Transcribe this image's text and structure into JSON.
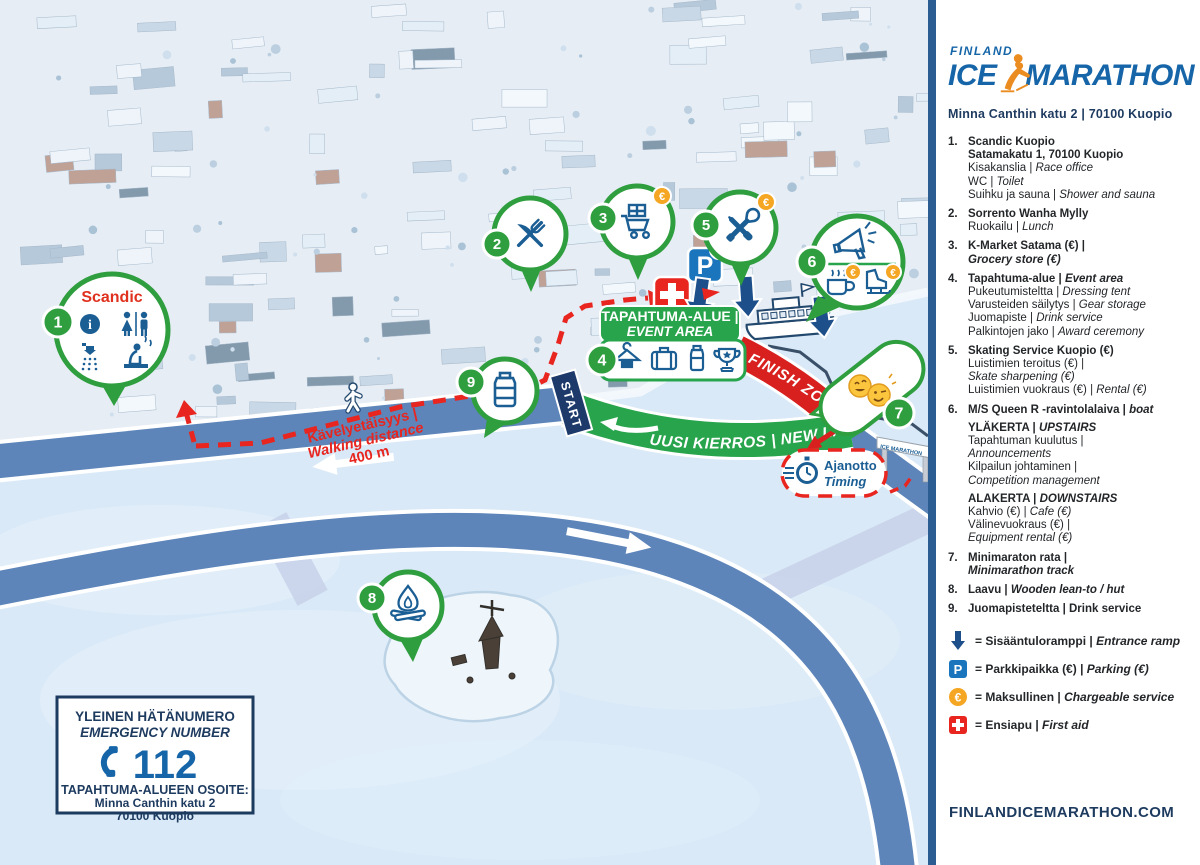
{
  "logo": {
    "finland": "FINLAND",
    "ice": "ICE",
    "marathon": "MARATHON",
    "address": "Minna Canthin katu 2  |  70100 Kuopio"
  },
  "legend": {
    "items": [
      {
        "num": "1.",
        "lines": [
          {
            "segs": [
              {
                "t": "Scandic Kuopio",
                "s": "b"
              }
            ]
          },
          {
            "segs": [
              {
                "t": "Satamakatu 1, 70100 Kuopio",
                "s": "b"
              }
            ]
          },
          {
            "segs": [
              {
                "t": "Kisakanslia | ",
                "s": "r"
              },
              {
                "t": "Race office",
                "s": "i"
              }
            ]
          },
          {
            "segs": [
              {
                "t": "WC | ",
                "s": "r"
              },
              {
                "t": "Toilet",
                "s": "i"
              }
            ]
          },
          {
            "segs": [
              {
                "t": "Suihku ja sauna | ",
                "s": "r"
              },
              {
                "t": "Shower and sauna",
                "s": "i"
              }
            ]
          }
        ]
      },
      {
        "num": "2.",
        "lines": [
          {
            "segs": [
              {
                "t": "Sorrento Wanha Mylly",
                "s": "b"
              }
            ]
          },
          {
            "segs": [
              {
                "t": "Ruokailu | ",
                "s": "r"
              },
              {
                "t": "Lunch",
                "s": "i"
              }
            ]
          }
        ]
      },
      {
        "num": "3.",
        "lines": [
          {
            "segs": [
              {
                "t": "K-Market Satama (€) |",
                "s": "b"
              }
            ]
          },
          {
            "segs": [
              {
                "t": "Grocery store (€)",
                "s": "bi"
              }
            ]
          }
        ]
      },
      {
        "num": "4.",
        "lines": [
          {
            "segs": [
              {
                "t": "Tapahtuma-alue | ",
                "s": "b"
              },
              {
                "t": "Event area",
                "s": "bi"
              }
            ]
          },
          {
            "segs": [
              {
                "t": "Pukeutumisteltta | ",
                "s": "r"
              },
              {
                "t": "Dressing tent",
                "s": "i"
              }
            ]
          },
          {
            "segs": [
              {
                "t": "Varusteiden säilytys | ",
                "s": "r"
              },
              {
                "t": "Gear storage",
                "s": "i"
              }
            ]
          },
          {
            "segs": [
              {
                "t": "Juomapiste | ",
                "s": "r"
              },
              {
                "t": "Drink service",
                "s": "i"
              }
            ]
          },
          {
            "segs": [
              {
                "t": "Palkintojen jako | ",
                "s": "r"
              },
              {
                "t": "Award ceremony",
                "s": "i"
              }
            ]
          }
        ]
      },
      {
        "num": "5.",
        "lines": [
          {
            "segs": [
              {
                "t": "Skating Service Kuopio (€)",
                "s": "b"
              }
            ]
          },
          {
            "segs": [
              {
                "t": "Luistimien teroitus (€) |",
                "s": "r"
              }
            ]
          },
          {
            "segs": [
              {
                "t": "Skate sharpening (€)",
                "s": "i"
              }
            ]
          },
          {
            "segs": [
              {
                "t": "Luistimien vuokraus (€) | ",
                "s": "r"
              },
              {
                "t": "Rental (€)",
                "s": "i"
              }
            ]
          }
        ]
      },
      {
        "num": "6.",
        "lines": [
          {
            "segs": [
              {
                "t": "M/S Queen R -ravintolalaiva | ",
                "s": "b"
              },
              {
                "t": "boat",
                "s": "bi"
              }
            ]
          },
          {
            "mt": true,
            "segs": [
              {
                "t": "YLÄKERTA | ",
                "s": "b"
              },
              {
                "t": "UPSTAIRS",
                "s": "bi"
              }
            ]
          },
          {
            "segs": [
              {
                "t": "Tapahtuman kuulutus |",
                "s": "r"
              }
            ]
          },
          {
            "segs": [
              {
                "t": "Announcements",
                "s": "i"
              }
            ]
          },
          {
            "segs": [
              {
                "t": "Kilpailun johtaminen |",
                "s": "r"
              }
            ]
          },
          {
            "segs": [
              {
                "t": "Competition management",
                "s": "i"
              }
            ]
          },
          {
            "mt": true,
            "segs": [
              {
                "t": "ALAKERTA | ",
                "s": "b"
              },
              {
                "t": "DOWNSTAIRS",
                "s": "bi"
              }
            ]
          },
          {
            "segs": [
              {
                "t": "Kahvio (€) | ",
                "s": "r"
              },
              {
                "t": "Cafe (€)",
                "s": "i"
              }
            ]
          },
          {
            "segs": [
              {
                "t": "Välinevuokraus (€) |",
                "s": "r"
              }
            ]
          },
          {
            "segs": [
              {
                "t": "Equipment rental (€)",
                "s": "i"
              }
            ]
          }
        ]
      },
      {
        "num": "7.",
        "lines": [
          {
            "segs": [
              {
                "t": "Minimaraton rata |",
                "s": "b"
              }
            ]
          },
          {
            "segs": [
              {
                "t": "Minimarathon track",
                "s": "bi"
              }
            ]
          }
        ]
      },
      {
        "num": "8.",
        "lines": [
          {
            "segs": [
              {
                "t": "Laavu | ",
                "s": "b"
              },
              {
                "t": "Wooden lean-to / hut",
                "s": "bi"
              }
            ]
          }
        ]
      },
      {
        "num": "9.",
        "lines": [
          {
            "segs": [
              {
                "t": "Juomapisteteltta | Drink service",
                "s": "b"
              }
            ]
          }
        ]
      }
    ]
  },
  "symbols": [
    {
      "icon": "entrance-ramp",
      "segs": [
        {
          "t": "= Sisääntuloramppi | ",
          "s": "b"
        },
        {
          "t": "Entrance ramp",
          "s": "bi"
        }
      ]
    },
    {
      "icon": "parking",
      "segs": [
        {
          "t": "= Parkkipaikka (€) | ",
          "s": "b"
        },
        {
          "t": "Parking (€)",
          "s": "bi"
        }
      ]
    },
    {
      "icon": "chargeable",
      "segs": [
        {
          "t": "= Maksullinen | ",
          "s": "b"
        },
        {
          "t": "Chargeable service",
          "s": "bi"
        }
      ]
    },
    {
      "icon": "first-aid",
      "segs": [
        {
          "t": "= Ensiapu | ",
          "s": "b"
        },
        {
          "t": "First aid",
          "s": "bi"
        }
      ]
    }
  ],
  "website": "FINLANDICEMARATHON.COM",
  "map": {
    "markers": [
      "1",
      "2",
      "3",
      "4",
      "5",
      "6",
      "7",
      "8",
      "9"
    ],
    "euro": "€",
    "parking": "P",
    "scandic_label": "Scandic",
    "event_area_line1": "TAPAHTUMA-ALUE |",
    "event_area_line2": "EVENT AREA",
    "start_label": "START",
    "new_lap_label": "UUSI KIERROS | NEW LAP",
    "finish_zone_label": "FINISH ZONE",
    "walking_line1": "Kävelyetäisyys |",
    "walking_line2": "Walking distance",
    "walking_line3": "400 m",
    "timing_fi": "Ajanotto",
    "timing_en": "Timing",
    "gate_label": "ICE MARATHON",
    "emergency": {
      "title_fi": "YLEINEN HÄTÄNUMERO",
      "title_en": "EMERGENCY NUMBER",
      "number": "112",
      "address_label": "TAPAHTUMA-ALUEEN OSOITE:",
      "address_line1": "Minna Canthin katu 2",
      "address_line2": "70100 Kuopio"
    },
    "colors": {
      "green": "#2f9e3f",
      "track_blue": "#5d85ba",
      "red": "#d8211f",
      "navy": "#1d3a5f",
      "icon_blue": "#1b5e94",
      "orange": "#f5a623"
    }
  }
}
